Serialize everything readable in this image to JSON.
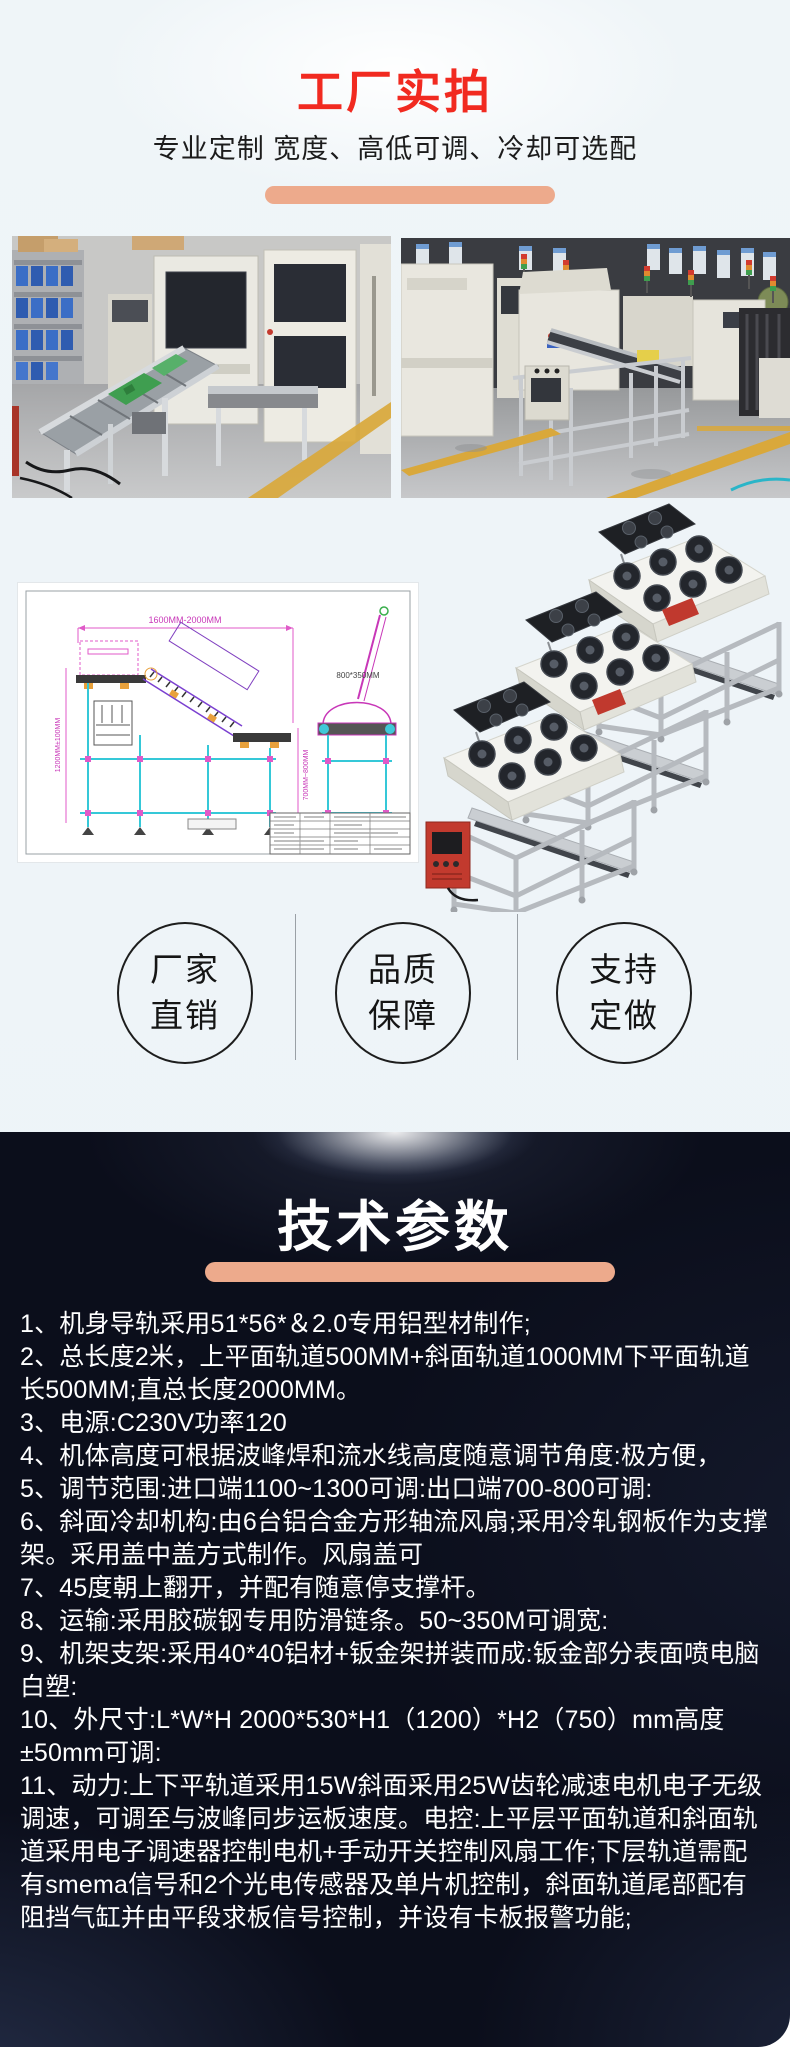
{
  "hero": {
    "title": "工厂实拍",
    "title_color": "#f12a20",
    "subtitle": "专业定制 宽度、高低可调、冷却可选配",
    "accent_color": "#edaa8c"
  },
  "gallery": {
    "photo_left_name": "factory-photo-left",
    "photo_right_name": "factory-photo-right"
  },
  "drawing": {
    "dim_top": "1600MM-2000MM",
    "dim_left": "1200MM±100MM",
    "dim_right": "700MM~800MM",
    "dim_end_view": "800*350MM"
  },
  "badges": {
    "items": [
      {
        "line1": "厂家",
        "line2": "直销"
      },
      {
        "line1": "品质",
        "line2": "保障"
      },
      {
        "line1": "支持",
        "line2": "定做"
      }
    ]
  },
  "specs": {
    "title": "技术参数",
    "bg_color": "#0b0e1b",
    "text_color": "#ffffff",
    "accent_color": "#edaa8c",
    "items": [
      "1、机身导轨采用51*56*＆2.0专用铝型材制作;",
      "2、总长度2米，上平面轨道500MM+斜面轨道1000MM下平面轨道长500MM;直总长度2000MM。",
      "3、电源:C230V功率120",
      "4、机体高度可根据波峰焊和流水线高度随意调节角度:极方便，",
      "5、调节范围:进口端1100~1300可调:出口端700-800可调:",
      "6、斜面冷却机构:由6台铝合金方形轴流风扇;采用冷轧钢板作为支撑架。采用盖中盖方式制作。风扇盖可",
      "7、45度朝上翻开，并配有随意停支撑杆。",
      "8、运输:采用胶碳钢专用防滑链条。50~350M可调宽:",
      "9、机架支架:采用40*40铝材+钣金架拼装而成:钣金部分表面喷电脑白塑:",
      "10、外尺寸:L*W*H  2000*530*H1（1200）*H2（750）mm高度±50mm可调:",
      "11、动力:上下平轨道采用15W斜面采用25W齿轮减速电机电子无级调速，可调至与波峰同步运板速度。电控:上平层平面轨道和斜面轨道采用电子调速器控制电机+手动开关控制风扇工作;下层轨道需配有smema信号和2个光电传感器及单片机控制，斜面轨道尾部配有阻挡气缸并由平段求板信号控制，并设有卡板报警功能;"
    ]
  }
}
